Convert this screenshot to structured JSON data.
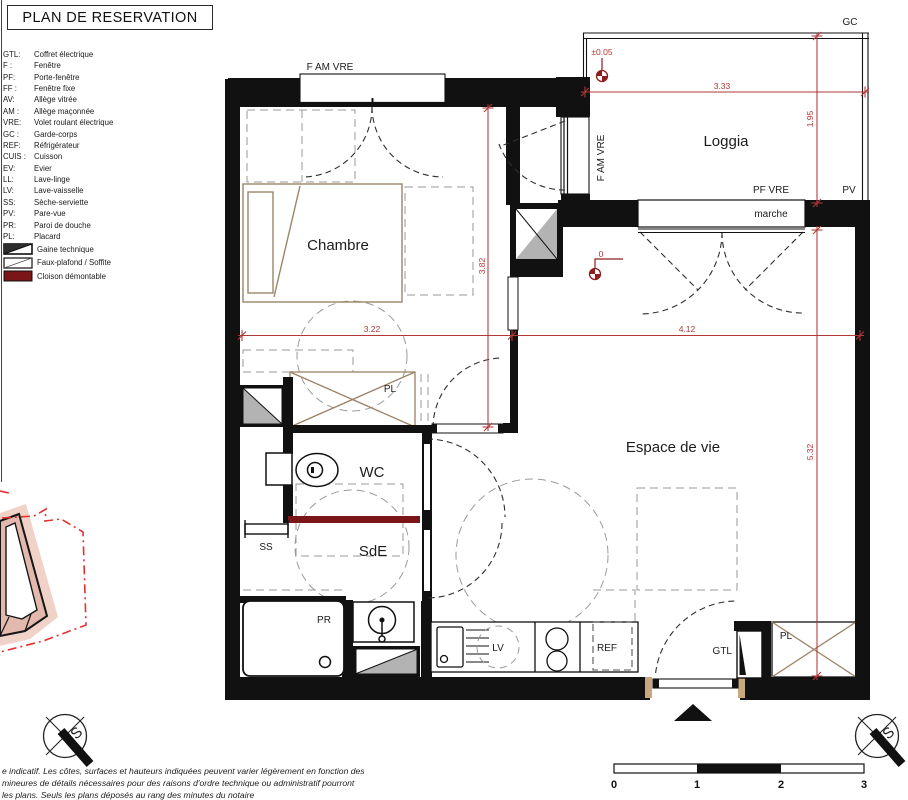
{
  "title": "PLAN DE RESERVATION",
  "legend": {
    "items": [
      {
        "abbr": "GTL:",
        "label": "Coffret électrique"
      },
      {
        "abbr": "F :",
        "label": "Fenêtre"
      },
      {
        "abbr": "PF:",
        "label": "Porte-fenêtre"
      },
      {
        "abbr": "FF :",
        "label": "Fenêtre fixe"
      },
      {
        "abbr": "AV:",
        "label": "Allège vitrée"
      },
      {
        "abbr": "AM :",
        "label": "Allège maçonnée"
      },
      {
        "abbr": "VRE:",
        "label": "Volet roulant électrique"
      },
      {
        "abbr": "GC :",
        "label": "Garde-corps"
      },
      {
        "abbr": "REF:",
        "label": "Réfrigérateur"
      },
      {
        "abbr": "CUIS :",
        "label": "Cuisson"
      },
      {
        "abbr": "EV:",
        "label": "Evier"
      },
      {
        "abbr": "LL:",
        "label": "Lave-linge"
      },
      {
        "abbr": "LV:",
        "label": "Lave-vaisselle"
      },
      {
        "abbr": "SS:",
        "label": "Sèche-serviette"
      },
      {
        "abbr": "PV:",
        "label": "Pare-vue"
      },
      {
        "abbr": "PR:",
        "label": "Paroi de douche"
      },
      {
        "abbr": "PL:",
        "label": "Placard"
      }
    ],
    "symbols": [
      {
        "name": "gaine-technique",
        "label": "Gaine technique"
      },
      {
        "name": "faux-plafond",
        "label": "Faux-plafond / Soffite"
      },
      {
        "name": "cloison-demontable",
        "label": "Cloison démontable"
      }
    ]
  },
  "plan": {
    "rooms": {
      "chambre": "Chambre",
      "loggia": "Loggia",
      "wc": "WC",
      "sde": "SdE",
      "espace": "Espace de vie"
    },
    "labels": {
      "f_am_vre_top": "F AM VRE",
      "f_am_vre_loggia": "F AM VRE",
      "pf_vre": "PF VRE",
      "pv": "PV",
      "gc": "GC",
      "marche": "marche",
      "pl_chambre": "PL",
      "pl_entree": "PL",
      "ss": "SS",
      "pr": "PR",
      "lv": "LV",
      "ref": "REF",
      "gtl": "GTL"
    },
    "dimensions": {
      "loggia_width": "3.33",
      "loggia_depth": "1.95",
      "chambre_width": "3.22",
      "espace_width": "4.12",
      "chambre_depth": "3.82",
      "espace_depth": "5.32",
      "level_loggia": "±0.05",
      "level_espace": "0"
    }
  },
  "scale_bar": {
    "labels": [
      "0",
      "1",
      "2",
      "3"
    ]
  },
  "compass": {
    "letter": "S"
  },
  "footer": {
    "line1": "e indicatif. Les côtes, surfaces et hauteurs indiquées peuvent varier légèrement en fonction des",
    "line2": "mineures de détails nécessaires pour des raisons d'ordre technique ou administratif pourront",
    "line3": "les plans. Seuls les plans déposés au rang des minutes du notaire"
  },
  "colors": {
    "dimension_red": "#b23737",
    "cloison_red": "#7a1518",
    "wall_black": "#111111",
    "wood_brown": "#9b8568",
    "site_pink": "#e2b9ac"
  }
}
